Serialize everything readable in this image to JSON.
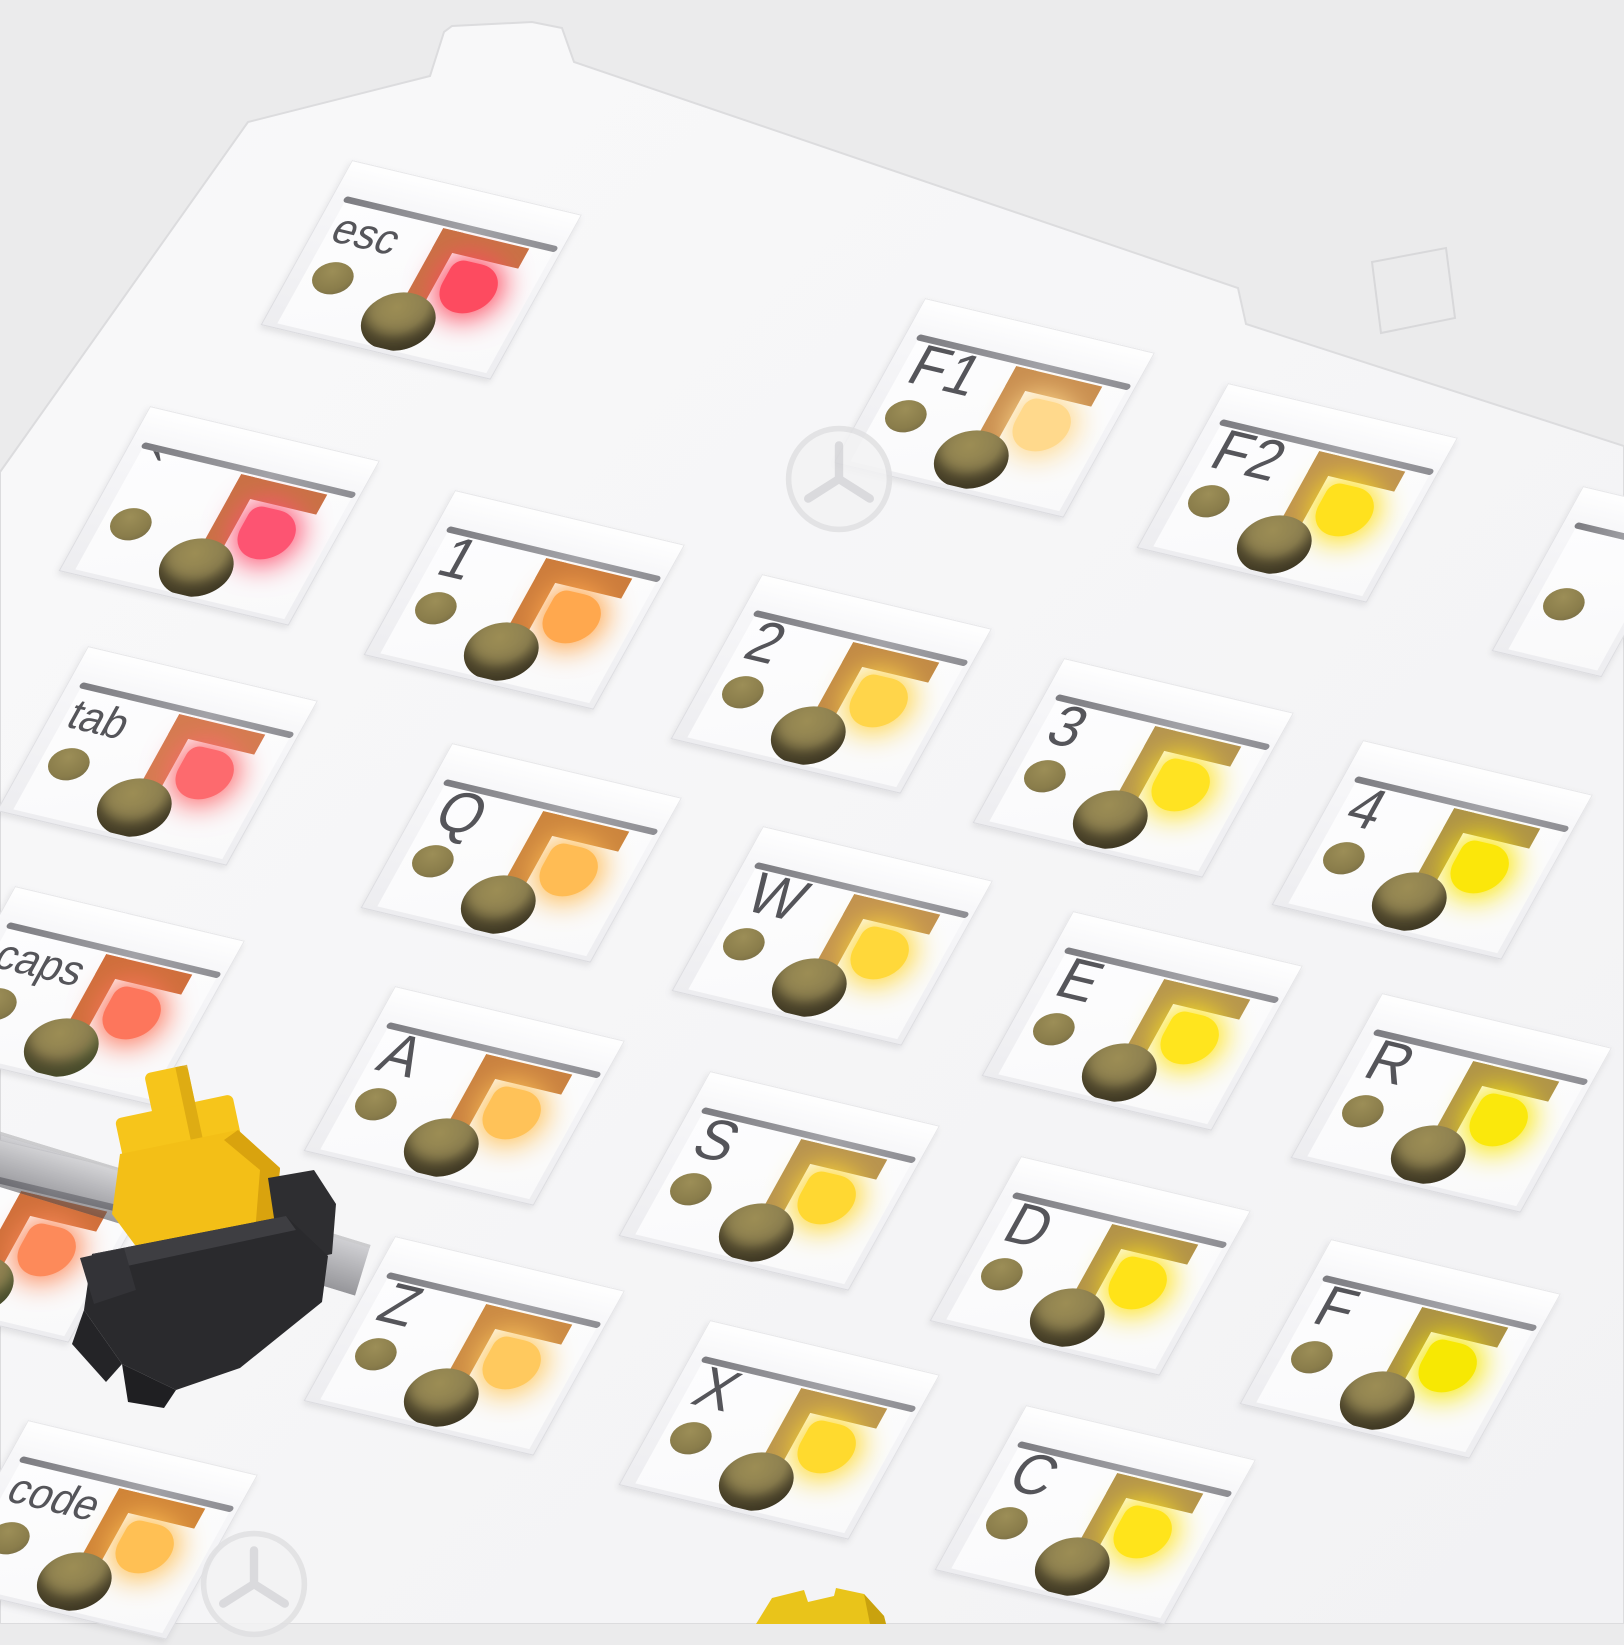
{
  "scene": {
    "type": "keyboard-plate-render",
    "description": "Angled close-up render of a white hot-swap mechanical keyboard plate/PCB: square per-key cutouts expose white PCB with gray silkscreen key legends, copper hot-swap contact pads, lit status LEDs fading from red/pink (top-left) to bright yellow (bottom-right), olive mounting holes, two faint tri-point screws, and one loose yellow-stem switch with black housing resting on the plate edge",
    "background_color": "#ebebec",
    "plate_color": "#f6f6f8",
    "hole_color": "#8a7d4b",
    "silkscreen_color": "#55555a"
  },
  "sockets": [
    {
      "id": "esc",
      "label": "esc",
      "x": 352,
      "y": 160,
      "bracket": "#c97245",
      "led": "#fd4b60"
    },
    {
      "id": "f1",
      "label": "F1",
      "x": 925,
      "y": 298,
      "bracket": "#c98e50",
      "led": "#ffd98c"
    },
    {
      "id": "f2",
      "label": "F2",
      "x": 1228,
      "y": 383,
      "bracket": "#bf9350",
      "led": "#ffe11e"
    },
    {
      "id": "f3",
      "label": "",
      "x": 1583,
      "y": 486,
      "sliver": true
    },
    {
      "id": "backtick",
      "label": "`",
      "x": 150,
      "y": 406,
      "bracket": "#c97245",
      "led": "#fd5472"
    },
    {
      "id": "1",
      "label": "1",
      "x": 455,
      "y": 490,
      "bracket": "#cc7c3c",
      "led": "#ffa84e"
    },
    {
      "id": "2",
      "label": "2",
      "x": 762,
      "y": 574,
      "bracket": "#c28a46",
      "led": "#ffd54a"
    },
    {
      "id": "3",
      "label": "3",
      "x": 1064,
      "y": 658,
      "bracket": "#b59450",
      "led": "#ffe322"
    },
    {
      "id": "4",
      "label": "4",
      "x": 1363,
      "y": 740,
      "bracket": "#ae9348",
      "led": "#fbe70a"
    },
    {
      "id": "tab",
      "label": "tab",
      "x": 88,
      "y": 646,
      "bracket": "#d47c50",
      "led": "#fd6a6e"
    },
    {
      "id": "q",
      "label": "Q",
      "x": 452,
      "y": 743,
      "bracket": "#cc853e",
      "led": "#ffbc54"
    },
    {
      "id": "w",
      "label": "W",
      "x": 763,
      "y": 826,
      "bracket": "#c29250",
      "led": "#ffd83a"
    },
    {
      "id": "e",
      "label": "E",
      "x": 1073,
      "y": 911,
      "bracket": "#b7964e",
      "led": "#ffe51e"
    },
    {
      "id": "r",
      "label": "R",
      "x": 1382,
      "y": 993,
      "bracket": "#b09449",
      "led": "#fae80c"
    },
    {
      "id": "caps",
      "label": "caps",
      "x": 15,
      "y": 886,
      "bracket": "#cf6f3c",
      "led": "#fd765c",
      "hole": "green"
    },
    {
      "id": "a",
      "label": "A",
      "x": 395,
      "y": 986,
      "bracket": "#c98140",
      "led": "#ffc258"
    },
    {
      "id": "s",
      "label": "S",
      "x": 710,
      "y": 1071,
      "bracket": "#b89350",
      "led": "#ffd832"
    },
    {
      "id": "d",
      "label": "D",
      "x": 1021,
      "y": 1156,
      "bracket": "#b2924a",
      "led": "#ffe318"
    },
    {
      "id": "f",
      "label": "F",
      "x": 1331,
      "y": 1239,
      "bracket": "#ab9145",
      "led": "#f7e803"
    },
    {
      "id": "shift-partial",
      "label": "",
      "x": -70,
      "y": 1123,
      "bracket": "#cf6f3a",
      "led": "#fd8a5a",
      "hole": "green"
    },
    {
      "id": "z",
      "label": "Z",
      "x": 395,
      "y": 1236,
      "bracket": "#cb8a44",
      "led": "#ffc95e"
    },
    {
      "id": "x",
      "label": "X",
      "x": 710,
      "y": 1320,
      "bracket": "#bb954e",
      "led": "#ffda2e"
    },
    {
      "id": "c",
      "label": "C",
      "x": 1026,
      "y": 1405,
      "bracket": "#b4944c",
      "led": "#ffe41b"
    },
    {
      "id": "code",
      "label": "code",
      "x": 28,
      "y": 1420,
      "bracket": "#d08438",
      "led": "#ffc054"
    }
  ],
  "loose_switch": {
    "stem_color": "#f6c51b",
    "upper_housing_color": "#f3bf17",
    "lower_housing_color": "#2a2a2d",
    "description": "unseated mechanical switch lying against plate edge, yellow stem and top housing, black bottom housing with mounting legs"
  },
  "second_switch_stem": {
    "color": "#e9c41a",
    "x": 752,
    "y": 1586
  },
  "screws": [
    {
      "x": 783,
      "y": 423
    },
    {
      "x": 198,
      "y": 1528
    }
  ]
}
